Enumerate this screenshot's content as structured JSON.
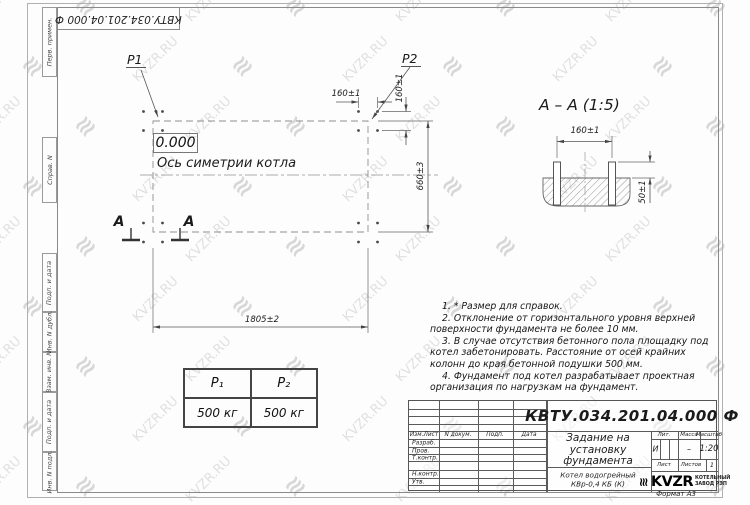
{
  "watermark": {
    "text": "KVZR.RU",
    "glyph": "≋",
    "color": "#c9c9c9"
  },
  "margin": {
    "stamp": "КВТУ.034.201.04.000  Ф",
    "cells": [
      "Перв. примен.",
      "Справ. N",
      "Подп. и дата",
      "Инв. N дубл.",
      "Взам. инв. N",
      "Подп. и дата",
      "Инв. N подл."
    ]
  },
  "plan": {
    "p1": "P1",
    "p2": "P2",
    "zero_level": "0.000",
    "axis_label": "Ось симетрии котла",
    "dim_bolt_h": "160±1",
    "dim_bolt_v": "160±1",
    "dim_width": "660±3",
    "dim_length": "1805±2",
    "section_letter_left": "А",
    "section_letter_right": "А"
  },
  "section": {
    "title": "А – А  (1:5)",
    "dim_bolts": "160±1",
    "dim_height": "50±1"
  },
  "notes": {
    "items": [
      "1. * Размер для справок.",
      "2. Отклонение от горизонтального уровня верхней поверхности фундамента не более 10 мм.",
      "3. В случае отсутствия бетонного пола площадку под котел забетонировать. Расстояние от осей крайних колонн до края бетонной подушки 500 мм.",
      "4. Фундамент под котел разрабатывает проектная организация по нагрузкам на фундамент."
    ]
  },
  "load_table": {
    "headers": [
      "P₁",
      "P₂"
    ],
    "values": [
      "500 кг",
      "500 кг"
    ]
  },
  "title_block": {
    "doc_number": "КВТУ.034.201.04.000  Ф",
    "title_lines": [
      "Задание на",
      "установку",
      "фундамента"
    ],
    "product_lines": [
      "Котел водогрейный",
      "КВр-0,4  КБ  (К)"
    ],
    "header_cells": [
      "Изм.Лист",
      "N докум.",
      "Подп.",
      "Дата"
    ],
    "rows": [
      "Разраб.",
      "Пров.",
      "Т.контр.",
      "Н.контр.",
      "Утв."
    ],
    "lit_label": "Лит.",
    "lit_value": "И",
    "mass_label": "Масса",
    "mass_value": "–",
    "scale_label": "Масштаб",
    "scale_value": "1:20",
    "sheet_label": "Лист",
    "sheets_label": "Листов",
    "sheets_value": "1",
    "logo_mark": "≋",
    "logo_word": "KVZR",
    "company_lines": [
      "КОТЕЛЬНЫЙ",
      "ЗАВОД РЭП"
    ],
    "format": "Формат А3"
  }
}
